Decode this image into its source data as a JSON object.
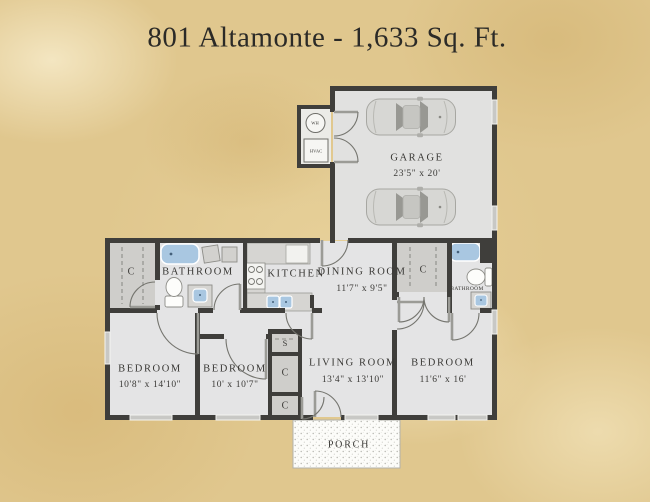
{
  "title": "801 Altamonte - 1,633 Sq. Ft.",
  "rooms": {
    "garage": {
      "label": "GARAGE",
      "size": "23'5\" x 20'"
    },
    "bathroom1": {
      "label": "BATHROOM"
    },
    "kitchen": {
      "label": "KITCHEN"
    },
    "dining_room": {
      "label": "DINING ROOM",
      "size": "11'7\" x 9'5\""
    },
    "bathroom2": {
      "label": "BATHROOM"
    },
    "bedroom1": {
      "label": "BEDROOM",
      "size": "10'8\" x 14'10\""
    },
    "bedroom2": {
      "label": "BEDROOM",
      "size": "10' x 10'7\""
    },
    "living_room": {
      "label": "LIVING ROOM",
      "size": "13'4\" x 13'10\""
    },
    "bedroom3": {
      "label": "BEDROOM",
      "size": "11'6\" x 16'"
    },
    "porch": {
      "label": "PORCH"
    }
  },
  "markers": {
    "closet": "C",
    "shelf": "S",
    "water_heater": "WH",
    "hvac": "HVAC"
  },
  "colors": {
    "background": "#e0c78e",
    "wall": "#3f3e3b",
    "floor": "#e4e4e5",
    "closet_fill": "#cfcecb",
    "counter": "#d6d5d2",
    "fixture_blue": "#a9c7e1",
    "window": "#c8c8c5",
    "text": "#3a3936"
  }
}
